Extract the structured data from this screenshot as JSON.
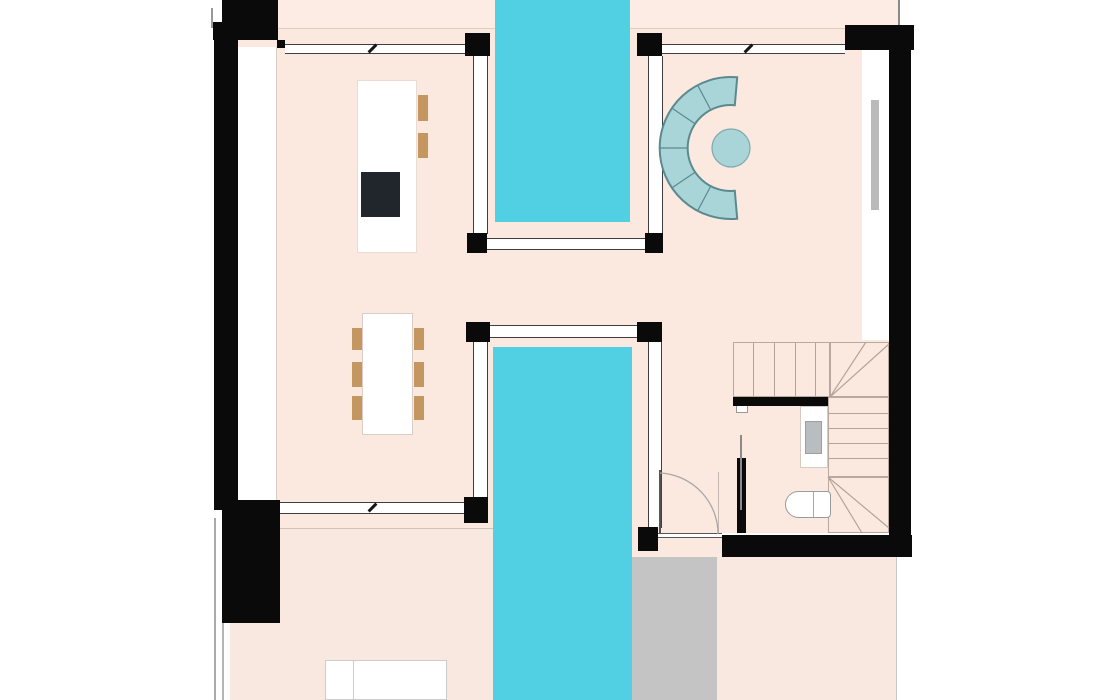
{
  "meta": {
    "title": "villa-floor-plan",
    "canvas": {
      "w": 1120,
      "h": 700
    },
    "background": "#ffffff"
  },
  "palette": {
    "wall": "#0a0a0a",
    "floor": "#fbe9e0",
    "pool": "#50d0e2",
    "terrace_gray": "#c5c4c4",
    "glass_feature_fill": "#a9d5d8",
    "glass_feature_stroke": "#5a8a90",
    "wood": "#c49760",
    "cooktop": "#20262c",
    "stair_line": "#b3a49a",
    "band_line": "#3f3f3f"
  },
  "elements": [
    {
      "name": "roof-strip-floor",
      "x": 278,
      "y": 0,
      "w": 621,
      "h": 28,
      "bg": "#fcece4"
    },
    {
      "name": "main-floor",
      "x": 238,
      "y": 28,
      "w": 651,
      "h": 505,
      "bg": "#fbe9e0"
    },
    {
      "name": "hall-floor-extension",
      "x": 632,
      "y": 533,
      "w": 90,
      "h": 24,
      "bg": "#fbe9e0"
    },
    {
      "name": "terrace-left-floor",
      "x": 230,
      "y": 528,
      "w": 265,
      "h": 172,
      "bg": "#f9e8e0"
    },
    {
      "name": "terrace-right-floor",
      "x": 717,
      "y": 557,
      "w": 180,
      "h": 143,
      "bg": "#f9e8e0"
    },
    {
      "name": "terrace-gray-deck",
      "x": 632,
      "y": 557,
      "w": 85,
      "h": 143,
      "bg": "#c5c4c4"
    },
    {
      "name": "roof-strip-edge-line",
      "x": 278,
      "y": 28,
      "w": 621,
      "h": 1,
      "bg": "#dccec6"
    },
    {
      "name": "terrace-left-edge-line",
      "x": 280,
      "y": 528,
      "w": 213,
      "h": 1,
      "bg": "#cfc3bb"
    },
    {
      "name": "terrace-right-edge-line",
      "x": 896,
      "y": 557,
      "w": 1,
      "h": 143,
      "bg": "#c9c9c9"
    },
    {
      "name": "left-wall-cavity",
      "x": 238,
      "y": 47,
      "w": 39,
      "h": 456,
      "bg": "#ffffff"
    },
    {
      "name": "left-cavity-edge-line",
      "x": 276,
      "y": 47,
      "w": 1,
      "h": 456,
      "bg": "#d8ccc4"
    },
    {
      "name": "right-window-bay",
      "x": 862,
      "y": 50,
      "w": 27,
      "h": 290,
      "bg": "#ffffff"
    },
    {
      "name": "bay-window-bar",
      "x": 871,
      "y": 100,
      "w": 8,
      "h": 110,
      "bg": "#bababa"
    },
    {
      "name": "exterior-line-top-left",
      "x": 211,
      "y": 8,
      "w": 2,
      "h": 20,
      "bg": "#999999"
    },
    {
      "name": "exterior-line-bottom-left-outer",
      "x": 214,
      "y": 518,
      "w": 2,
      "h": 182,
      "bg": "#aaaaaa"
    },
    {
      "name": "exterior-line-bottom-left-inner",
      "x": 222,
      "y": 623,
      "w": 2,
      "h": 77,
      "bg": "#b5b5b5"
    },
    {
      "name": "exterior-line-top-right",
      "x": 898,
      "y": 0,
      "w": 2,
      "h": 26,
      "bg": "#8a8a8a"
    },
    {
      "name": "pool-upper",
      "x": 495,
      "y": 0,
      "w": 135,
      "h": 222,
      "bg": "#50d0e2"
    },
    {
      "name": "pool-lower",
      "x": 493,
      "y": 347,
      "w": 139,
      "h": 353,
      "bg": "#50d0e2"
    },
    {
      "name": "glazing-band-top-left",
      "x": 285,
      "y": 44,
      "w": 180,
      "h": 10,
      "bg": "#ffffff",
      "edges": "y",
      "ec": "#3f3f3f"
    },
    {
      "name": "glazing-band-top-right",
      "x": 662,
      "y": 44,
      "w": 183,
      "h": 10,
      "bg": "#ffffff",
      "edges": "y",
      "ec": "#3f3f3f"
    },
    {
      "name": "glazing-band-pool1-left",
      "x": 473,
      "y": 56,
      "w": 15,
      "h": 178,
      "bg": "#ffffff",
      "edges": "x",
      "ec": "#3f3f3f"
    },
    {
      "name": "glazing-band-pool1-right",
      "x": 648,
      "y": 56,
      "w": 15,
      "h": 178,
      "bg": "#ffffff",
      "edges": "x",
      "ec": "#3f3f3f"
    },
    {
      "name": "glazing-band-pool1-bottom",
      "x": 470,
      "y": 238,
      "w": 190,
      "h": 12,
      "bg": "#ffffff",
      "edges": "y",
      "ec": "#3f3f3f"
    },
    {
      "name": "glazing-band-pool2-top",
      "x": 466,
      "y": 325,
      "w": 196,
      "h": 13,
      "bg": "#ffffff",
      "edges": "y",
      "ec": "#3f3f3f"
    },
    {
      "name": "glazing-band-pool2-left",
      "x": 473,
      "y": 342,
      "w": 15,
      "h": 156,
      "bg": "#ffffff",
      "edges": "x",
      "ec": "#3f3f3f"
    },
    {
      "name": "glazing-band-pool2-right",
      "x": 648,
      "y": 342,
      "w": 14,
      "h": 186,
      "bg": "#ffffff",
      "edges": "x",
      "ec": "#3f3f3f"
    },
    {
      "name": "glazing-band-terrace-left",
      "x": 280,
      "y": 502,
      "w": 184,
      "h": 12,
      "bg": "#ffffff",
      "edges": "y",
      "ec": "#3f3f3f"
    },
    {
      "name": "bath-door-wall",
      "x": 656,
      "y": 533,
      "w": 66,
      "h": 5,
      "bg": "#ffffff",
      "edges": "y",
      "ec": "#555555",
      "bw": 1
    },
    {
      "name": "slider-tick-top-left",
      "x": 371,
      "y": 43,
      "w": 3,
      "h": 11,
      "bg": "#151515",
      "rot": 45
    },
    {
      "name": "slider-tick-top-right",
      "x": 747,
      "y": 43,
      "w": 3,
      "h": 11,
      "bg": "#151515",
      "rot": 45
    },
    {
      "name": "slider-tick-terrace",
      "x": 371,
      "y": 502,
      "w": 3,
      "h": 11,
      "bg": "#151515",
      "rot": 45
    },
    {
      "name": "stair-upper-flight",
      "x": 733,
      "y": 342,
      "w": 97,
      "h": 55,
      "edges": "all",
      "ec": "#b8a89e"
    },
    {
      "name": "stair-tread",
      "x": 753,
      "y": 342,
      "w": 1,
      "h": 55,
      "bg": "#b3a49a"
    },
    {
      "name": "stair-tread",
      "x": 774,
      "y": 342,
      "w": 1,
      "h": 55,
      "bg": "#b3a49a"
    },
    {
      "name": "stair-tread",
      "x": 795,
      "y": 342,
      "w": 1,
      "h": 55,
      "bg": "#b3a49a"
    },
    {
      "name": "stair-tread",
      "x": 815,
      "y": 342,
      "w": 1,
      "h": 55,
      "bg": "#b3a49a"
    },
    {
      "name": "stair-winder-top",
      "x": 830,
      "y": 342,
      "w": 59,
      "h": 55,
      "edges": "all",
      "ec": "#b8a89e"
    },
    {
      "name": "stair-right-flight",
      "x": 828,
      "y": 397,
      "w": 61,
      "h": 80,
      "edges": "all",
      "ec": "#b8a89e"
    },
    {
      "name": "stair-tread",
      "x": 828,
      "y": 413,
      "w": 61,
      "h": 1,
      "bg": "#b3a49a"
    },
    {
      "name": "stair-tread",
      "x": 828,
      "y": 428,
      "w": 61,
      "h": 1,
      "bg": "#b3a49a"
    },
    {
      "name": "stair-tread",
      "x": 828,
      "y": 443,
      "w": 61,
      "h": 1,
      "bg": "#b3a49a"
    },
    {
      "name": "stair-tread",
      "x": 828,
      "y": 458,
      "w": 61,
      "h": 1,
      "bg": "#b3a49a"
    },
    {
      "name": "stair-winder-bottom",
      "x": 828,
      "y": 477,
      "w": 61,
      "h": 56,
      "edges": "all",
      "ec": "#b8a89e"
    },
    {
      "name": "kitchen-island",
      "x": 357,
      "y": 80,
      "w": 60,
      "h": 173,
      "bg": "#ffffff",
      "edges": "all",
      "ec": "#e8dcd4"
    },
    {
      "name": "kitchen-cooktop",
      "x": 361,
      "y": 172,
      "w": 39,
      "h": 45,
      "bg": "#20262c"
    },
    {
      "name": "kitchen-stool",
      "x": 418,
      "y": 95,
      "w": 10,
      "h": 26,
      "bg": "#c49760"
    },
    {
      "name": "kitchen-stool",
      "x": 418,
      "y": 133,
      "w": 10,
      "h": 25,
      "bg": "#c49760"
    },
    {
      "name": "dining-table",
      "x": 362,
      "y": 313,
      "w": 51,
      "h": 122,
      "bg": "#ffffff",
      "edges": "all",
      "ec": "#d9cec7"
    },
    {
      "name": "dining-chair",
      "x": 352,
      "y": 328,
      "w": 10,
      "h": 22,
      "bg": "#c49760"
    },
    {
      "name": "dining-chair",
      "x": 352,
      "y": 362,
      "w": 10,
      "h": 25,
      "bg": "#c49760"
    },
    {
      "name": "dining-chair",
      "x": 352,
      "y": 396,
      "w": 10,
      "h": 24,
      "bg": "#c49760"
    },
    {
      "name": "dining-chair",
      "x": 414,
      "y": 328,
      "w": 10,
      "h": 22,
      "bg": "#c49760"
    },
    {
      "name": "dining-chair",
      "x": 414,
      "y": 362,
      "w": 10,
      "h": 25,
      "bg": "#c49760"
    },
    {
      "name": "dining-chair",
      "x": 414,
      "y": 396,
      "w": 10,
      "h": 24,
      "bg": "#c49760"
    },
    {
      "name": "bed",
      "x": 325,
      "y": 660,
      "w": 122,
      "h": 40,
      "bg": "#ffffff",
      "edges": "all",
      "ec": "#cccccc"
    },
    {
      "name": "bed-divider-line",
      "x": 353,
      "y": 661,
      "w": 1,
      "h": 39,
      "bg": "#cccccc"
    },
    {
      "name": "bath-sink-counter",
      "x": 800,
      "y": 406,
      "w": 28,
      "h": 62,
      "bg": "#ffffff",
      "edges": "all",
      "ec": "#d6cac2"
    },
    {
      "name": "bath-sink-basin",
      "x": 805,
      "y": 421,
      "w": 17,
      "h": 33,
      "bg": "#b9bdc0",
      "edges": "all",
      "ec": "#9aa1a5"
    },
    {
      "name": "bath-wall-fixture",
      "x": 736,
      "y": 404,
      "w": 12,
      "h": 9,
      "bg": "#ffffff",
      "edges": "all",
      "ec": "#999999"
    },
    {
      "name": "toilet",
      "x": 785,
      "y": 491,
      "w": 46,
      "h": 27,
      "bg": "#ffffff",
      "edges": "all",
      "ec": "#9b9b9b",
      "radius": "14px 4px 4px 14px"
    },
    {
      "name": "toilet-tank-line",
      "x": 813,
      "y": 492,
      "w": 1,
      "h": 25,
      "bg": "#a8a8a8"
    },
    {
      "name": "door-leaf",
      "x": 659,
      "y": 470,
      "w": 2,
      "h": 63,
      "bg": "#555555"
    },
    {
      "name": "door-jamb-line",
      "x": 718,
      "y": 472,
      "w": 1,
      "h": 61,
      "bg": "#c4b8b0"
    },
    {
      "name": "wall-top-left-block",
      "x": 222,
      "y": 0,
      "w": 56,
      "h": 40,
      "bg": "#0a0a0a"
    },
    {
      "name": "wall-top-left-step",
      "x": 213,
      "y": 22,
      "w": 9,
      "h": 18,
      "bg": "#0a0a0a"
    },
    {
      "name": "wall-left",
      "x": 214,
      "y": 28,
      "w": 24,
      "h": 482,
      "bg": "#0a0a0a"
    },
    {
      "name": "wall-bottom-left-block",
      "x": 222,
      "y": 500,
      "w": 58,
      "h": 123,
      "bg": "#0a0a0a"
    },
    {
      "name": "wall-band-nub",
      "x": 277,
      "y": 40,
      "w": 8,
      "h": 8,
      "bg": "#0a0a0a"
    },
    {
      "name": "post-pool1-top-left",
      "x": 465,
      "y": 33,
      "w": 25,
      "h": 23,
      "bg": "#0a0a0a"
    },
    {
      "name": "post-pool1-top-right",
      "x": 637,
      "y": 33,
      "w": 25,
      "h": 23,
      "bg": "#0a0a0a"
    },
    {
      "name": "wall-top-right-block",
      "x": 845,
      "y": 25,
      "w": 69,
      "h": 25,
      "bg": "#0a0a0a"
    },
    {
      "name": "wall-right",
      "x": 889,
      "y": 50,
      "w": 22,
      "h": 507,
      "bg": "#0a0a0a"
    },
    {
      "name": "wall-bottom",
      "x": 722,
      "y": 535,
      "w": 190,
      "h": 22,
      "bg": "#0a0a0a"
    },
    {
      "name": "post-pool1-bottom-left",
      "x": 467,
      "y": 233,
      "w": 20,
      "h": 20,
      "bg": "#0a0a0a"
    },
    {
      "name": "post-pool1-bottom-right",
      "x": 645,
      "y": 233,
      "w": 18,
      "h": 20,
      "bg": "#0a0a0a"
    },
    {
      "name": "post-pool2-top-left",
      "x": 466,
      "y": 322,
      "w": 24,
      "h": 20,
      "bg": "#0a0a0a"
    },
    {
      "name": "post-pool2-top-right",
      "x": 637,
      "y": 322,
      "w": 25,
      "h": 20,
      "bg": "#0a0a0a"
    },
    {
      "name": "post-pool2-bottom-left",
      "x": 464,
      "y": 497,
      "w": 24,
      "h": 26,
      "bg": "#0a0a0a"
    },
    {
      "name": "post-pool2-bottom-right",
      "x": 638,
      "y": 527,
      "w": 20,
      "h": 24,
      "bg": "#0a0a0a"
    },
    {
      "name": "stair-side-wall",
      "x": 733,
      "y": 397,
      "w": 95,
      "h": 9,
      "bg": "#0a0a0a"
    },
    {
      "name": "wc-partition-wall",
      "x": 737,
      "y": 458,
      "w": 9,
      "h": 75,
      "bg": "#0a0a0a"
    },
    {
      "name": "wc-sliding-door-line",
      "x": 740,
      "y": 435,
      "w": 2,
      "h": 75,
      "bg": "#8a8a8a"
    }
  ],
  "svgs": [
    {
      "name": "curved-glass-feature",
      "x": 650,
      "y": 65,
      "w": 110,
      "h": 165,
      "items": [
        {
          "type": "path",
          "name": "curved-glass-ring",
          "d": "M87.2 12.3 A71 71 0 1 0 87.2 153.7 L84.8 125.8 A43 43 0 1 1 84.8 40.2 Z",
          "fill": "#a9d5d8",
          "stroke": "#5a8a90",
          "sw": 2
        },
        {
          "type": "path",
          "name": "curved-glass-segment-lines",
          "d": "M47.7 20.3 L60.8 45 M22.1 43.3 L45.4 59 M10 83 L38 83 M22.1 122.7 L45.4 107 M47.7 145.7 L60.8 121",
          "fill": "none",
          "stroke": "#5a8a90",
          "sw": 1.2
        },
        {
          "type": "circle",
          "name": "curved-glass-center-disc",
          "cx": 81,
          "cy": 83,
          "r": 19,
          "fill": "#a9d5d8",
          "stroke": "#7fa9ad",
          "sw": 1.2
        }
      ]
    },
    {
      "name": "stair-and-door-arcs",
      "x": 650,
      "y": 330,
      "w": 262,
      "h": 210,
      "items": [
        {
          "type": "path",
          "name": "door-swing-arc",
          "d": "M10 143 A61 61 0 0 1 68 204",
          "fill": "none",
          "stroke": "#a8a8a8",
          "sw": 1.3
        },
        {
          "type": "path",
          "name": "stair-winder-lines",
          "d": "M180 67 L239 14 M180 67 L216 12 M178 147 L239 198 M178 147 L212 203",
          "fill": "none",
          "stroke": "#b3a49a",
          "sw": 1.2
        }
      ]
    }
  ]
}
